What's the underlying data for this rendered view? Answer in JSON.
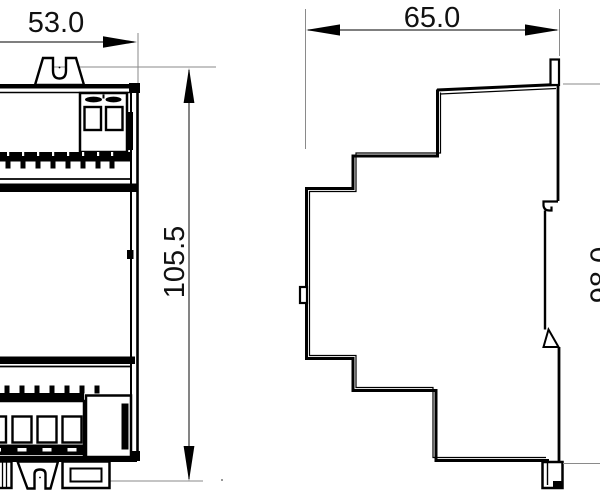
{
  "drawing": {
    "type": "technical-dimension-drawing",
    "views": [
      "front",
      "side"
    ],
    "dimensions": {
      "front_width": "53.0",
      "front_height": "105.5",
      "side_depth": "65.0",
      "side_height": "98.0"
    },
    "colors": {
      "outline": "#000000",
      "dimension_line": "#333333",
      "extension_line": "#8a8a8a",
      "background": "#ffffff"
    }
  }
}
